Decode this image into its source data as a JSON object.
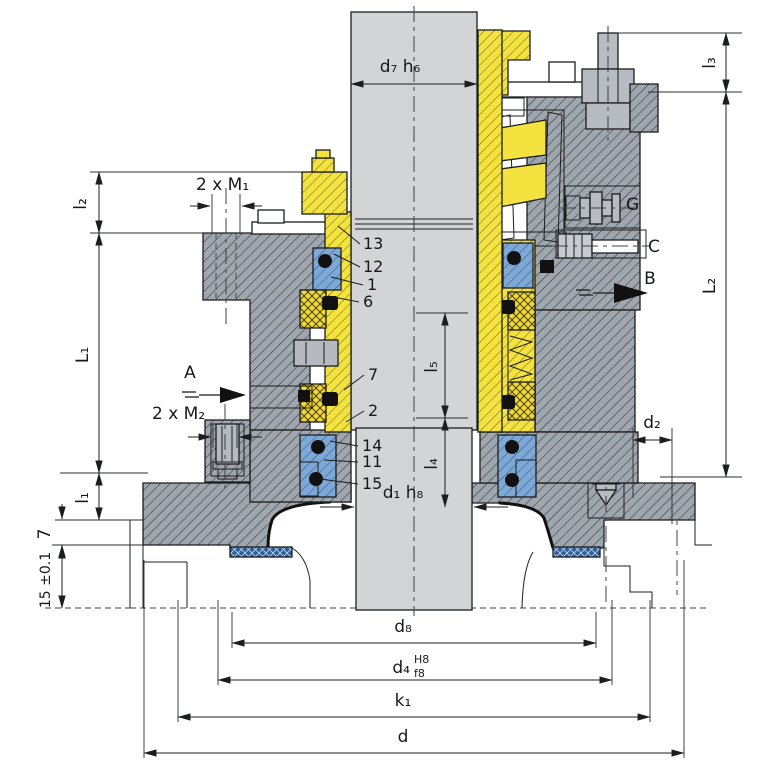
{
  "drawing": {
    "dims": {
      "d7h6": "d₇ h₆",
      "l3": "l₃",
      "L2": "L₂",
      "l2": "l₂",
      "m1": "2 x M₁",
      "L1": "L₁",
      "m2": "2 x M₂",
      "l5": "l₅",
      "l4": "l₄",
      "d1h8": "d₁ h₈",
      "l1": "l₁",
      "seven": "7",
      "fifteen": "15 ±0.1",
      "d2": "d₂",
      "d8": "d₈",
      "d4": "d₄",
      "d4_fit_upper": "H8",
      "d4_fit_lower": "f8",
      "k1": "k₁",
      "d": "d"
    },
    "ports": {
      "a": "A",
      "b": "B",
      "c": "C",
      "g": "G"
    },
    "parts": {
      "n13": "13",
      "n12": "12",
      "n1": "1",
      "n6": "6",
      "n7": "7",
      "n2": "2",
      "n14": "14",
      "n11": "11",
      "n15": "15"
    },
    "colors": {
      "shaft": "#d2d4d6",
      "housing": "#a0a6ad",
      "sleeve_yellow": "#f4e23e",
      "seal_blue": "#6d9bcd",
      "gasket_blue": "#2f5f98",
      "seal_black": "#111111"
    }
  }
}
